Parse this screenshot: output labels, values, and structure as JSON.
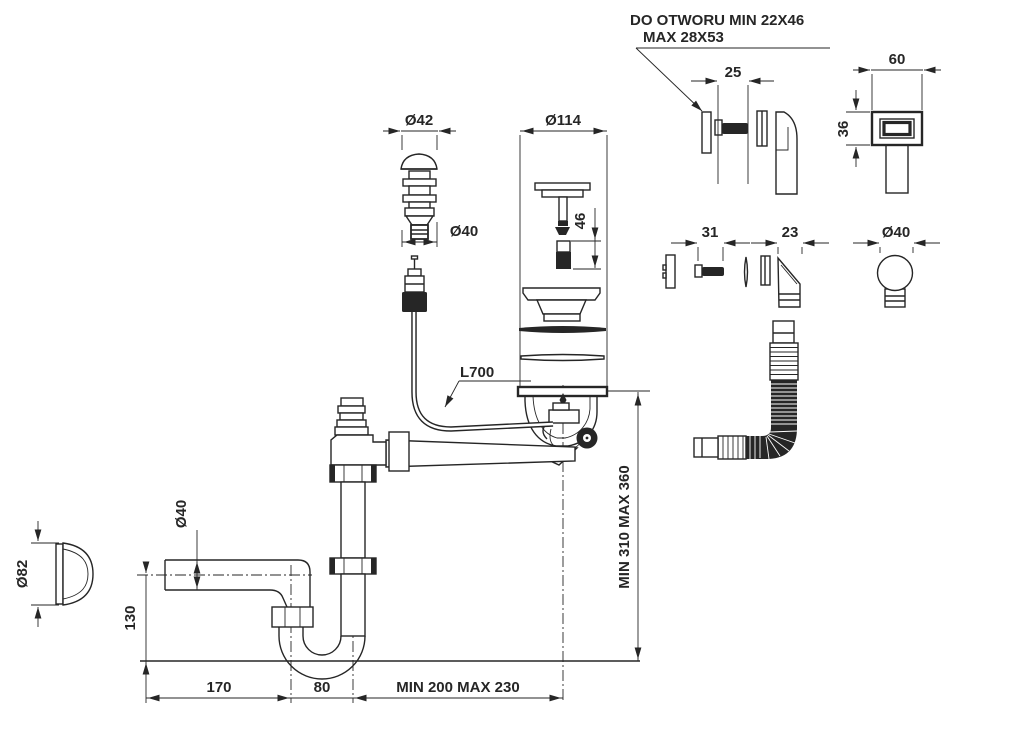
{
  "drawing": {
    "background": "#ffffff",
    "line_color": "#262626",
    "note": {
      "line1": "DO OTWORU MIN 22X46",
      "line2": "MAX 28X53"
    },
    "dimensions": {
      "overflow_screw_length": "25",
      "overflow_cover_width": "60",
      "overflow_cover_height": "36",
      "plug_cap_diameter": "Ø42",
      "plug_thread_diameter": "Ø40",
      "strainer_diameter": "Ø114",
      "plug_pin_height": "46",
      "screw_length": "31",
      "overflow_elbow_width": "23",
      "knob_diameter": "Ø40",
      "cable_length": "L700",
      "outlet_pipe_diameter": "Ø40",
      "side_cover_diameter": "Ø82",
      "trap_height": "130",
      "drain_height_range": "MIN 310 MAX 360",
      "trap_offset": "170",
      "trap_width": "80",
      "drain_distance_range": "MIN 200 MAX 230"
    }
  }
}
